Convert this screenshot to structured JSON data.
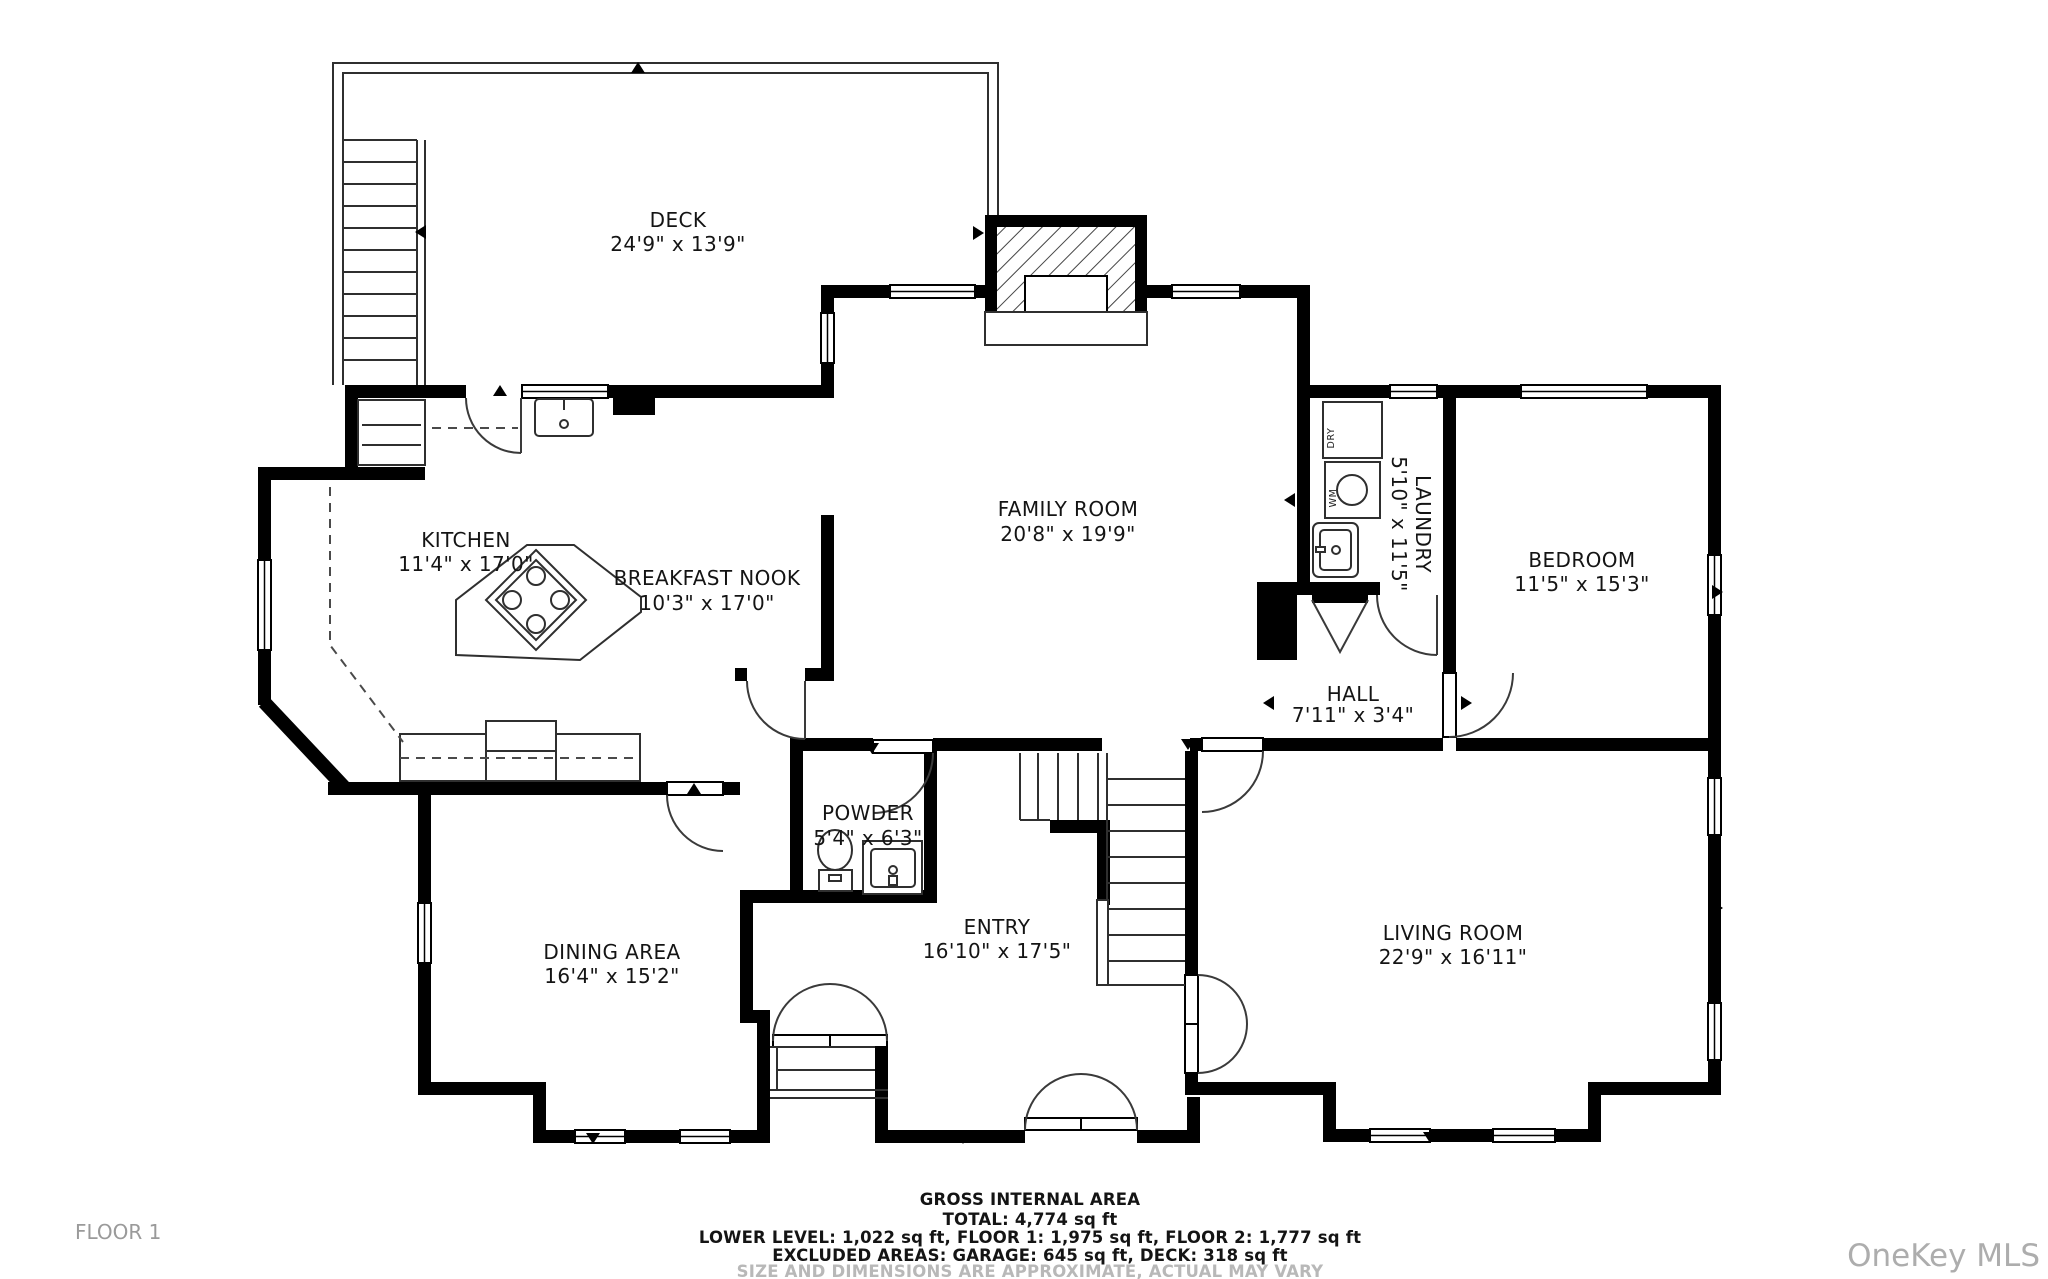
{
  "floor_label": "FLOOR 1",
  "watermark": "OneKey MLS",
  "footer": {
    "line1": "GROSS INTERNAL AREA",
    "line2": "TOTAL: 4,774 sq ft",
    "line3": "LOWER LEVEL: 1,022 sq ft, FLOOR 1: 1,975 sq ft, FLOOR 2: 1,777 sq ft",
    "line4": "EXCLUDED AREAS: GARAGE: 645 sq ft, DECK: 318 sq ft",
    "line5": "SIZE AND DIMENSIONS ARE APPROXIMATE, ACTUAL MAY VARY"
  },
  "rooms": {
    "deck": {
      "name": "DECK",
      "dims": "24'9\" x 13'9\""
    },
    "kitchen": {
      "name": "KITCHEN",
      "dims": "11'4\" x 17'0\""
    },
    "breakfast_nook": {
      "name": "BREAKFAST NOOK",
      "dims": "10'3\" x 17'0\""
    },
    "family_room": {
      "name": "FAMILY ROOM",
      "dims": "20'8\" x 19'9\""
    },
    "laundry": {
      "name": "LAUNDRY",
      "dims": "5'10\" x 11'5\""
    },
    "bedroom": {
      "name": "BEDROOM",
      "dims": "11'5\" x 15'3\""
    },
    "hall": {
      "name": "HALL",
      "dims": "7'11\" x 3'4\""
    },
    "powder": {
      "name": "POWDER",
      "dims": "5'4\" x 6'3\""
    },
    "entry": {
      "name": "ENTRY",
      "dims": "16'10\" x 17'5\""
    },
    "dining_area": {
      "name": "DINING AREA",
      "dims": "16'4\" x 15'2\""
    },
    "living_room": {
      "name": "LIVING ROOM",
      "dims": "22'9\" x 16'11\""
    }
  },
  "fixtures": {
    "dryer": "DRY",
    "washer": "WM"
  },
  "colors": {
    "wall": "#000000",
    "label": "#141414",
    "muted": "#9a9a9a",
    "watermark": "#adadad"
  }
}
